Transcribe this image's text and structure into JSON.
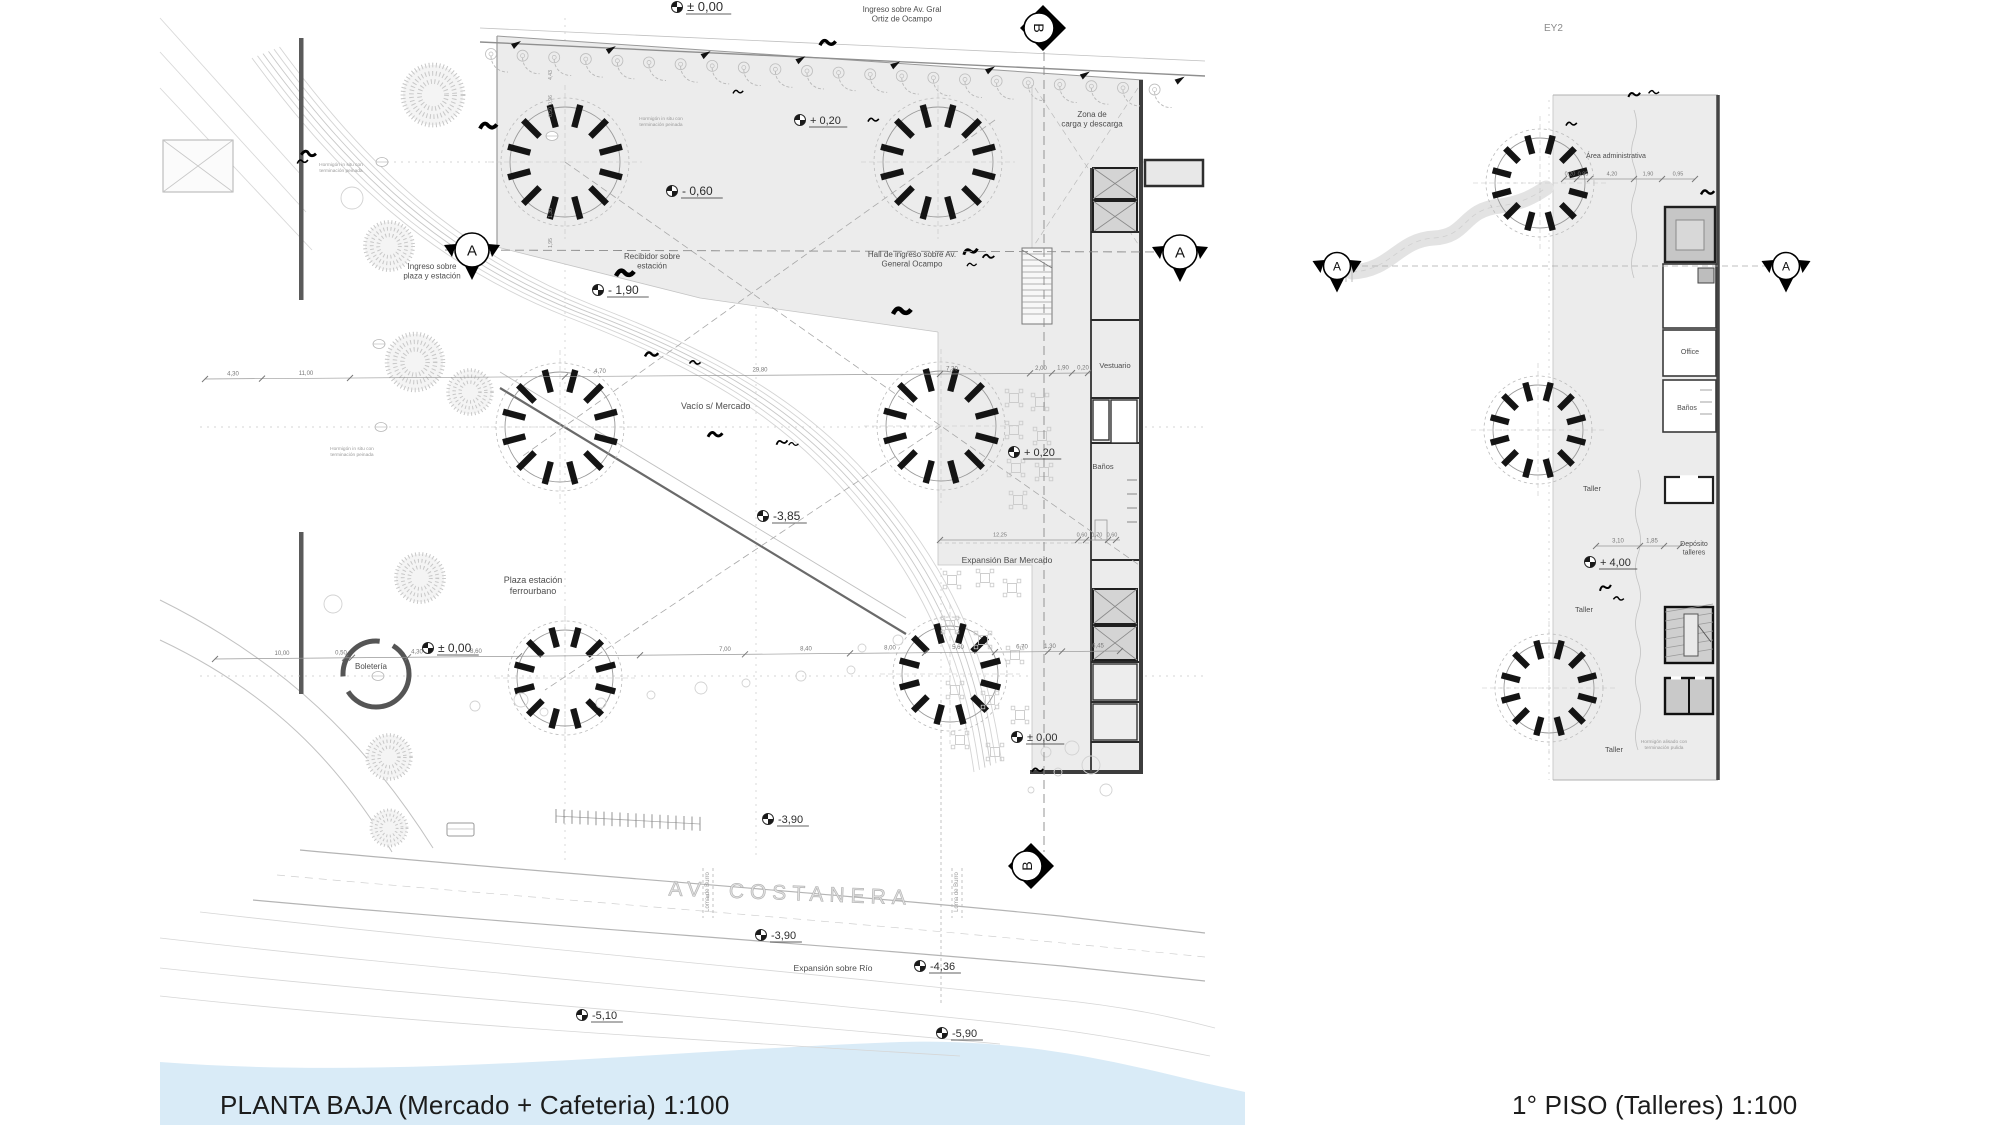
{
  "colors": {
    "water": "#d9ebf7",
    "plan_fill": "#ececec",
    "wall": "#333333",
    "annotation_text": "#4d4d4d"
  },
  "titles": {
    "left": "PLANTA BAJA (Mercado + Cafeteria) 1:100",
    "right": "1° PISO (Talleres) 1:100"
  },
  "key_label": "EY2",
  "section_markers": {
    "a": "A",
    "b": "B"
  },
  "annotations": {
    "ingreso_av": "Ingreso sobre Av. Gral|Ortiz de Ocampo",
    "zona_carga": "Zona de|carga y descarga",
    "ingreso_plaza": "Ingreso sobre|plaza y estación",
    "recibidor": "Recibidor sobre|estación",
    "hall_ingreso": "Hall de ingreso sobre Av.|General Ocampo",
    "vacio": "Vacío s/ Mercado",
    "vestuario": "Vestuario",
    "banos_pb": "Baños",
    "expansion_bar": "Expansión Bar Mercado",
    "plaza_estacion": "Plaza estación|ferrourbano",
    "boleteria": "Boletería",
    "av_costanera": "AV.  COSTANERA",
    "loma_burro": "Loma de Burro",
    "expansion_rio": "Expansión sobre Río",
    "area_admin": "Área administrativa",
    "office": "Office",
    "banos_p1": "Baños",
    "taller_1": "Taller",
    "taller_2": "Taller",
    "taller_3": "Taller",
    "deposito": "Depósito|talleres",
    "note_hormigon_in_situ": "Hormigón in situ con|terminación peinada",
    "note_hormigon_alisado": "Hormigón alisado con|terminación pulida"
  },
  "levels": {
    "pb_000_top": "± 0,00",
    "pb_m060": "- 0,60",
    "pb_m190": "- 1,90",
    "pb_p020_top": "+ 0,20",
    "pb_p020_bar": "+ 0,20",
    "pb_m385": "-3,85",
    "pb_000_plaza": "± 0,00",
    "pb_000_br": "± 0,00",
    "pb_m390_a": "-3,90",
    "pb_m390_b": "-3,90",
    "pb_m436": "-4,36",
    "pb_m510": "-5,10",
    "pb_m590": "-5,90",
    "p1_p400": "+ 4,00"
  },
  "dimensions": {
    "chain_upper": [
      "4,30",
      "11,00",
      "4,70",
      "29,80",
      "7,30",
      "2,00",
      "1,90",
      "0,20"
    ],
    "chain_lower": [
      "10,00",
      "0,50",
      "4,30",
      "8,60",
      "7,00",
      "8,40",
      "8,00",
      "5,60",
      "6,70",
      "1,30",
      "6,45"
    ],
    "chain_bar": [
      "12,25",
      "0,60",
      "1,70",
      "0,60"
    ],
    "chain_right_top": [
      "0,20",
      "0,95",
      "4,20",
      "1,90",
      "0,95"
    ],
    "chain_right_mid": [
      "3,10",
      "1,85"
    ],
    "vertical_left": [
      "4,43",
      "0,96",
      "0,50",
      "1,30",
      "1,95"
    ]
  }
}
